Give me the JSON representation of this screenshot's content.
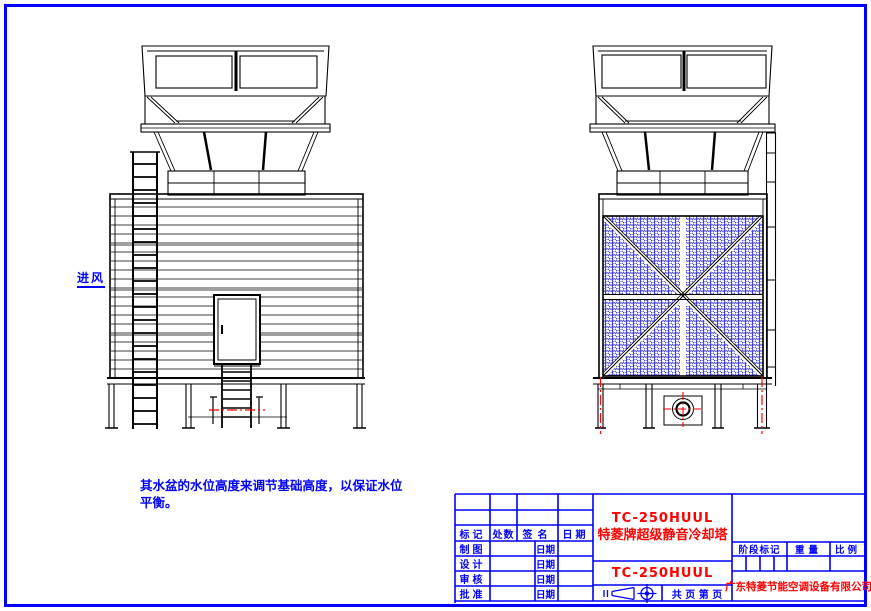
{
  "colors": {
    "frame_blue": "#0000ff",
    "drawing_black": "#000000",
    "accent_red": "#ff0000",
    "mesh_blue": "#1212d6"
  },
  "annotations": {
    "air_inlet": "进风",
    "note_line1": "其水盆的水位高度来调节基础高度，以保证水位",
    "note_line2": "平衡。"
  },
  "title_block": {
    "revision_headers": [
      "标记",
      "处数",
      "签名",
      "日期"
    ],
    "rows": [
      {
        "label": "制图",
        "date": "日期"
      },
      {
        "label": "设计",
        "date": "日期"
      },
      {
        "label": "审核",
        "date": "日期"
      },
      {
        "label": "批准",
        "date": "日期"
      }
    ],
    "model_code": "TC-250HUUL",
    "product_name": "特菱牌超级静音冷却塔",
    "drawing_code": "TC-250HUUL",
    "stage_mark": "阶段标记",
    "weight": "重量",
    "scale": "比例",
    "pages": "共  页  第  页",
    "company": "广东特菱节能空调设备有限公司"
  }
}
